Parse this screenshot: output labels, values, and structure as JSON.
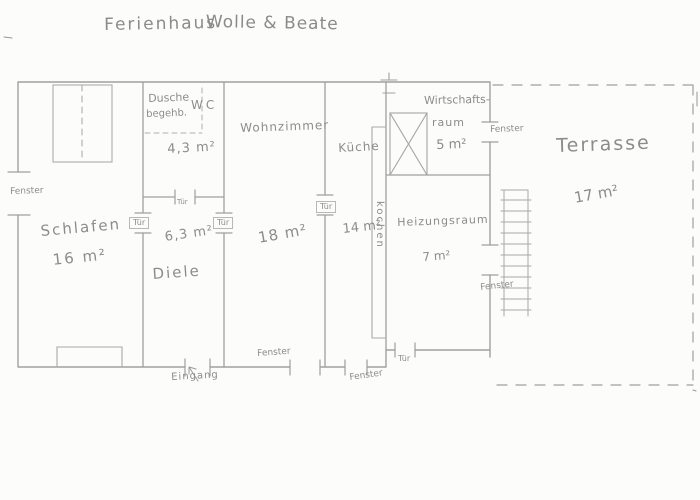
{
  "title": {
    "part1": "Ferienhaus",
    "part2": "Wolle & Beate"
  },
  "rooms": {
    "schlafen": {
      "name": "Schlafen",
      "area": "16 m²"
    },
    "diele": {
      "name": "Diele",
      "area": "6,3 m²"
    },
    "bad": {
      "dusche_line1": "Dusche",
      "dusche_line2": "begehb.",
      "wc": "WC",
      "area": "4,3 m²"
    },
    "wohnzimmer": {
      "name": "Wohnzimmer",
      "area": "18 m²"
    },
    "kueche": {
      "name": "Küche",
      "area": "14 m²",
      "counter_label": "kochen"
    },
    "wirtschaftsraum": {
      "name_line1": "Wirtschafts-",
      "name_line2": "raum",
      "area": "5 m²"
    },
    "heizungsraum": {
      "name": "Heizungsraum",
      "area": "7 m²"
    },
    "terrasse": {
      "name": "Terrasse",
      "area": "17 m²"
    }
  },
  "annotations": {
    "fenster": "Fenster",
    "tuer": "Tür",
    "eingang": "Eingang"
  },
  "colors": {
    "paper": "#fcfcfa",
    "pencil_line": "#a0a0a0",
    "pencil_text": "#8c8c8c"
  }
}
